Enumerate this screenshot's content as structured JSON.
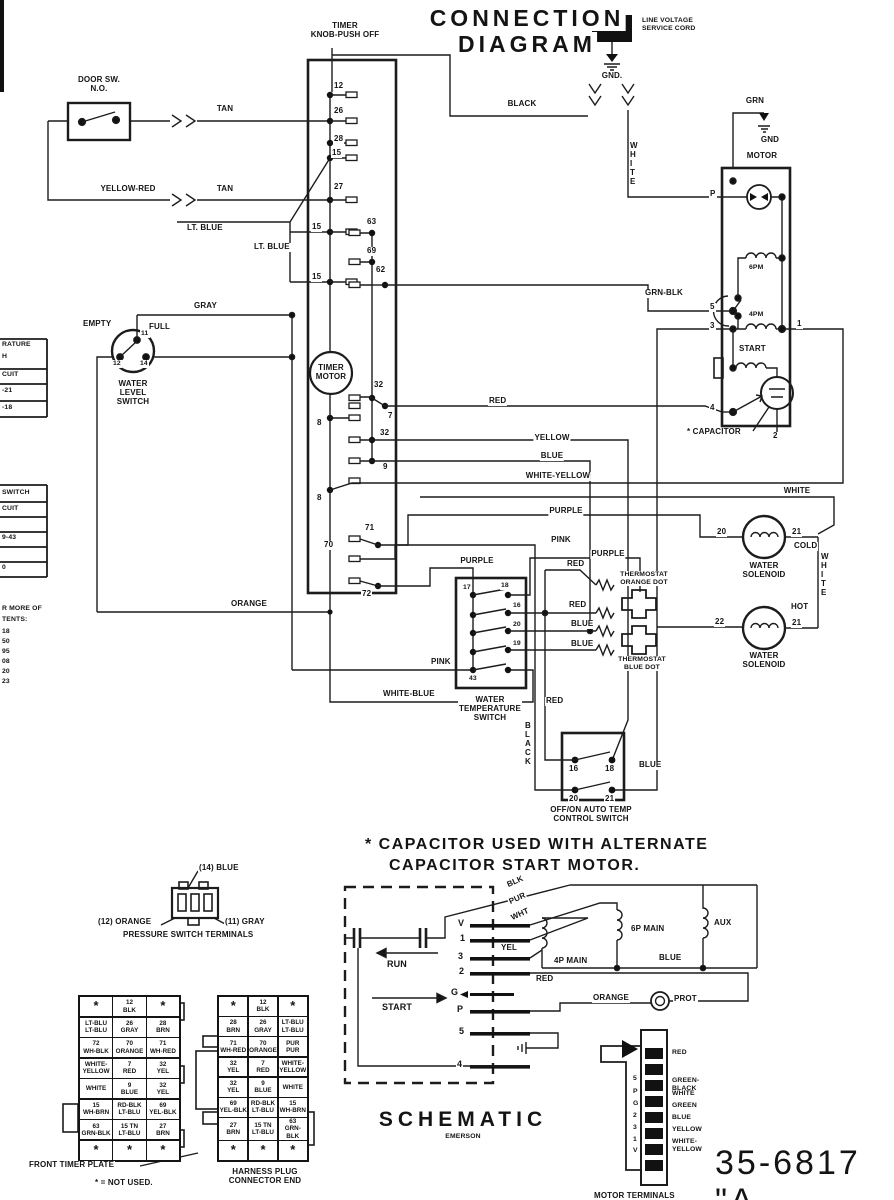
{
  "L": {
    "knob": "TIMER\nKNOB-PUSH OFF",
    "t1": "CONNECTION",
    "t2": "DIAGRAM",
    "lv": "LINE VOLTAGE\nSERVICE CORD",
    "gndd": "GND.",
    "door": "DOOR SW.\nN.O.",
    "grn": "GRN",
    "gnd": "GND",
    "motor": "MOTOR",
    "empty": "EMPTY",
    "full": "FULL",
    "wls": "WATER\nLEVEL\nSWITCH",
    "tm": "TIMER\nMOTOR",
    "startm": "START",
    "capn": "* CAPACITOR",
    "pm6": "6PM",
    "pm4": "4PM",
    "cold": "COLD",
    "hot": "HOT",
    "ws": "WATER\nSOLENOID",
    "wts": "WATER\nTEMPERATURE\nSWITCH",
    "tho": "THERMOSTAT\nORANGE DOT",
    "thb": "THERMOSTAT\nBLUE DOT",
    "ctl": "OFF/ON AUTO TEMP\nCONTROL SWITCH",
    "note1": "* CAPACITOR USED WITH ALTERNATE",
    "note2": "CAPACITOR START MOTOR.",
    "run": "RUN",
    "strt": "START",
    "blk": "BLK",
    "pur": "PUR",
    "wht": "WHT",
    "yel": "YEL",
    "m4p": "4P MAIN",
    "m6p": "6P MAIN",
    "aux": "AUX",
    "prot": "PROT",
    "schem": "SCHEMATIC",
    "emer": "EMERSON",
    "p14": "(14) BLUE",
    "p12": "(12) ORANGE",
    "p11": "(11) GRAY",
    "pcap": "PRESSURE SWITCH TERMINALS",
    "ftp": "FRONT TIMER PLATE",
    "nu": "* = NOT USED.",
    "hpc": "HARNESS PLUG\nCONNECTOR END",
    "mt": "MOTOR TERMINALS",
    "pn": "35-6817 \"A"
  },
  "c": {
    "tan": "TAN",
    "yr": "YELLOW-RED",
    "ltb": "LT. BLUE",
    "gray": "GRAY",
    "blk": "BLACK",
    "red": "RED",
    "yellow": "YELLOW",
    "blue": "BLUE",
    "wy": "WHITE-YELLOW",
    "white": "WHITE",
    "purple": "PURPLE",
    "pink": "PINK",
    "orange": "ORANGE",
    "wb": "WHITE-BLUE",
    "gb": "GRN-BLK",
    "wv": "W\nH\nI\nT\nE",
    "bv": "B\nL\nA\nC\nK"
  },
  "n": {
    "1": "1",
    "2": "2",
    "3": "3",
    "4": "4",
    "5": "5",
    "7": "7",
    "8": "8",
    "9": "9",
    "11": "11",
    "12": "12",
    "14": "14",
    "15": "15",
    "16": "16",
    "17": "17",
    "18": "18",
    "19": "19",
    "20": "20",
    "21": "21",
    "22": "22",
    "26": "26",
    "27": "27",
    "28": "28",
    "32": "32",
    "43": "43",
    "62": "62",
    "63": "63",
    "69": "69",
    "70": "70",
    "71": "71",
    "72": "72",
    "P": "P",
    "G": "G",
    "V": "V"
  },
  "left": {
    "a": [
      "RATURE",
      "H",
      "CUIT",
      "-21",
      "-18"
    ],
    "b": [
      "SWITCH",
      "CUIT",
      "9-43",
      "0"
    ],
    "c": [
      "R MORE OF",
      "TENTS:",
      "18",
      "50",
      "95",
      "08",
      "20",
      "23"
    ]
  },
  "timer_plate": {
    "rows": [
      [
        "*",
        "12|BLK",
        "*"
      ],
      [
        "LT-BLU|LT-BLU",
        "26|GRAY",
        "28|BRN"
      ],
      [
        "72|WH-BLK",
        "70|ORANGE",
        "71|WH-RED"
      ],
      [
        "WHITE-|YELLOW",
        "7|RED",
        "32|YEL"
      ],
      [
        "WHITE",
        "9|BLUE",
        "32|YEL"
      ],
      [
        "15|WH-BRN",
        "RD-BLK|LT-BLU",
        "69|YEL-BLK"
      ],
      [
        "63|GRN-BLK",
        "15 TN|LT-BLU",
        "27|BRN"
      ],
      [
        "*",
        "*",
        "*"
      ]
    ]
  },
  "harness_plug": {
    "rows": [
      [
        "*",
        "12|BLK",
        "*"
      ],
      [
        "28|BRN",
        "26|GRAY",
        "LT-BLU|LT-BLU"
      ],
      [
        "71|WH-RED",
        "70|ORANGE",
        "PUR|PUR"
      ],
      [
        "32|YEL",
        "7|RED",
        "WHITE-|YELLOW"
      ],
      [
        "32|YEL",
        "9|BLUE",
        "WHITE"
      ],
      [
        "69|YEL-BLK",
        "RD-BLK|LT-BLU",
        "15|WH-BRN"
      ],
      [
        "27|BRN",
        "15 TN|LT-BLU",
        "63|GRN-BLK"
      ],
      [
        "*",
        "*",
        "*"
      ]
    ]
  },
  "mt": {
    "pins": [
      "5",
      "P",
      "G",
      "2",
      "3",
      "1",
      "V"
    ],
    "wires": [
      "RED",
      "GREEN-BLACK",
      "WHITE",
      "GREEN",
      "BLUE",
      "YELLOW",
      "WHITE-YELLOW"
    ]
  }
}
